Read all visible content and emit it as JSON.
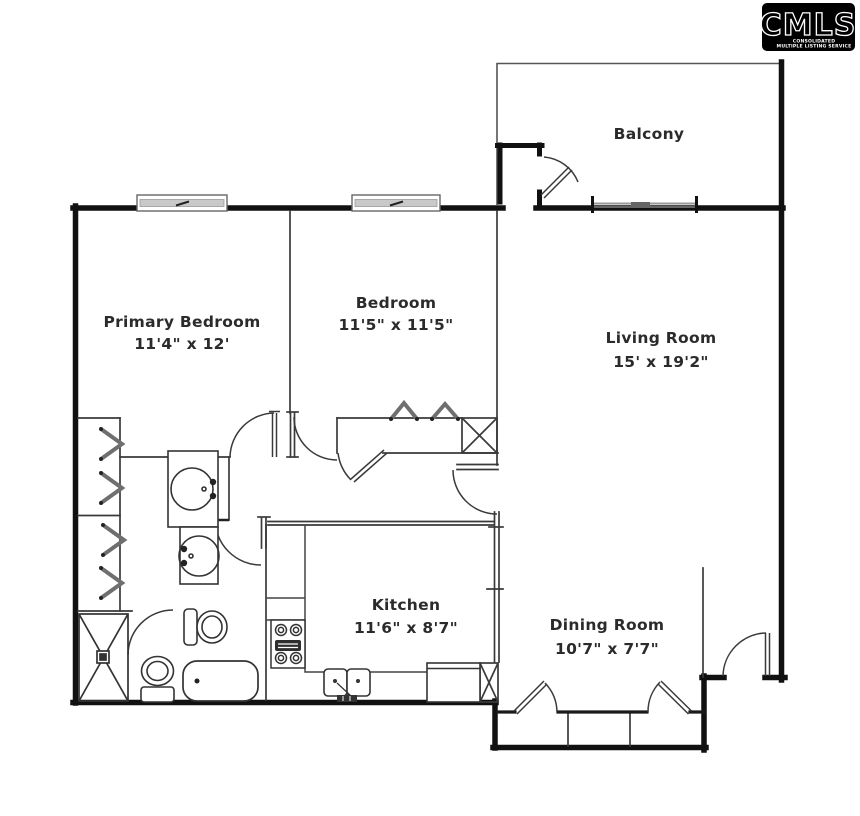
{
  "logo": {
    "brand": "CMLS",
    "tagline_line1": "CONSOLIDATED",
    "tagline_line2": "MULTIPLE LISTING SERVICE",
    "bg_color": "#000000",
    "text_color": "#ffffff"
  },
  "rooms": [
    {
      "id": "balcony",
      "name": "Balcony",
      "dims": ""
    },
    {
      "id": "primary-bedroom",
      "name": "Primary Bedroom",
      "dims": "11'4\" x 12'"
    },
    {
      "id": "bedroom",
      "name": "Bedroom",
      "dims": "11'5\" x 11'5\""
    },
    {
      "id": "living-room",
      "name": "Living Room",
      "dims": "15' x 19'2\""
    },
    {
      "id": "kitchen",
      "name": "Kitchen",
      "dims": "11'6\" x 8'7\""
    },
    {
      "id": "dining-room",
      "name": "Dining Room",
      "dims": "10'7\" x 7'7\""
    }
  ],
  "fixtures": [
    "shower-stall",
    "toilet",
    "toilet",
    "bathtub",
    "vanity-sink",
    "vanity-sink",
    "kitchen-double-sink",
    "stove-cooktop",
    "refrigerator",
    "pantry-cabinet",
    "utility-closet",
    "closet-rod",
    "window",
    "door-swing",
    "bifold-door"
  ],
  "colors": {
    "wall": "#111111",
    "thin_line": "#3a3a3a",
    "window_fill": "#c9c9c9",
    "label_text": "#2b2b2b",
    "background": "#ffffff"
  }
}
